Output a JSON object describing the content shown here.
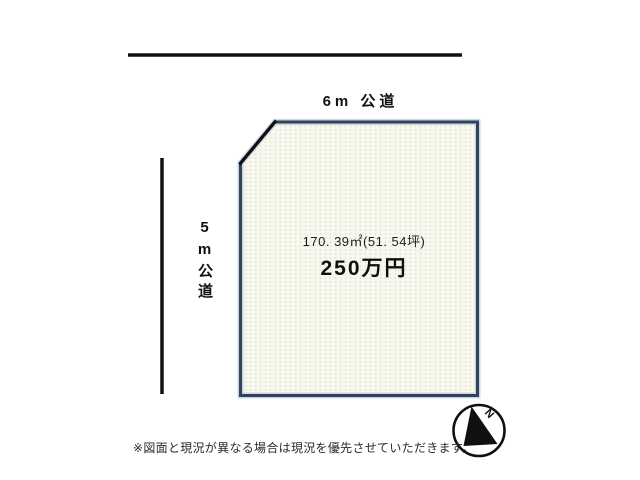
{
  "roads": {
    "top": {
      "label": "6m 公道"
    },
    "left": {
      "label": "5m公道"
    }
  },
  "plot": {
    "area_text": "170. 39㎡(51. 54坪)",
    "price_text": "250万円"
  },
  "compass": {
    "label": "N"
  },
  "note": "※図面と現況が異なる場合は現況を優先させていただきます。",
  "colors": {
    "plot_border": "#31435a",
    "plot_fill": "#f8f8ef",
    "road_line": "#111111",
    "text": "#1d1d1d"
  }
}
